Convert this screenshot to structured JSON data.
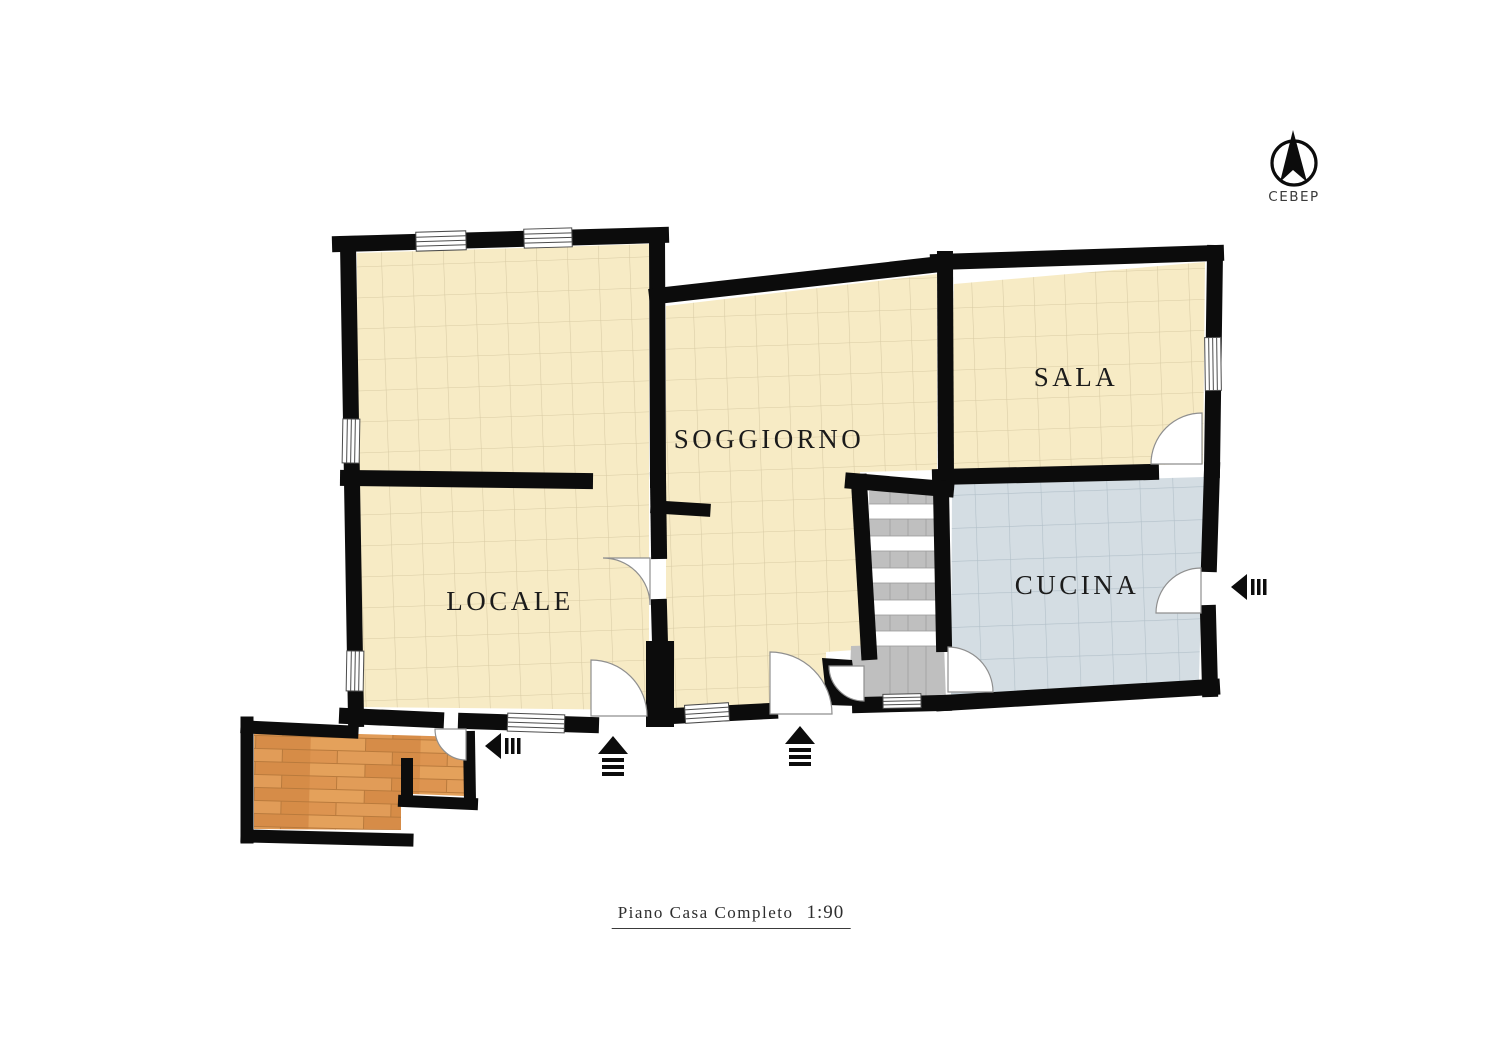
{
  "north_indicator": {
    "icon": "north-arrow-icon",
    "label": "СЕВЕР"
  },
  "rooms": {
    "locale": {
      "label": "LOCALE"
    },
    "soggiorno": {
      "label": "SOGGIORNO"
    },
    "sala": {
      "label": "SALA"
    },
    "cucina": {
      "label": "CUCINA"
    }
  },
  "title_block": {
    "label": "Piano Casa Completo",
    "scale": "1:90"
  },
  "colors": {
    "wall": "#0c0c0c",
    "cream_floor": "#f7ebc5",
    "cream_grid": "#d8cba4",
    "blue_floor": "#d4dde3",
    "blue_grid": "#b2c0c9",
    "stairs_gray": "#bfbfbf",
    "stairs_tick": "#a6a6a6",
    "tread_white": "#ffffff",
    "wood_base": "#dd9450",
    "wood_light": "#e8a761",
    "wood_dark": "#cf8440",
    "door_stroke": "#8f8f8f",
    "window_stroke": "#4c4c4c",
    "label_text": "#1b1b1b"
  }
}
